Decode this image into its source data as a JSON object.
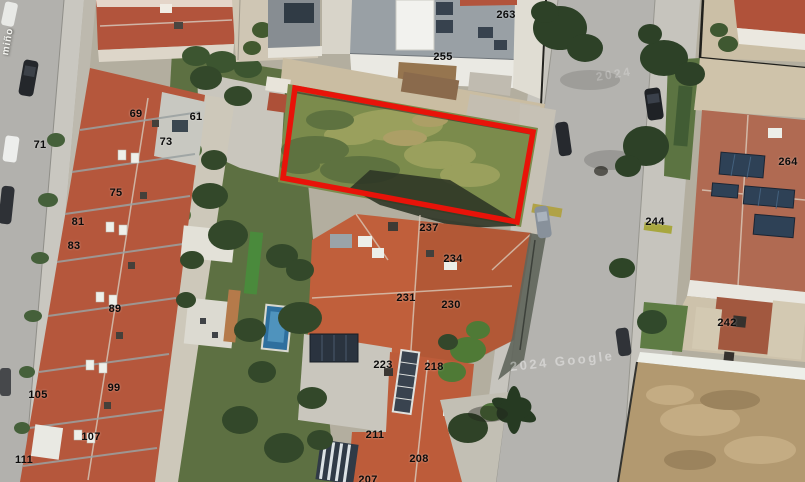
{
  "map": {
    "type": "satellite-aerial-view",
    "street_label": "miño",
    "watermarks": [
      {
        "text": "2024",
        "x": 596,
        "y": 82,
        "rotation": -9,
        "opacity": 0.22,
        "size": 12
      },
      {
        "text": "2024 Google",
        "x": 510,
        "y": 372,
        "rotation": -6,
        "opacity": 0.4,
        "size": 13
      }
    ],
    "parcel_outline": {
      "color": "#e81309",
      "stroke_width": 5.5,
      "points": "295,88 533,132 517,222 283,178"
    },
    "labels": [
      {
        "text": "69",
        "x": 136,
        "y": 114
      },
      {
        "text": "61",
        "x": 196,
        "y": 117
      },
      {
        "text": "71",
        "x": 40,
        "y": 145
      },
      {
        "text": "73",
        "x": 166,
        "y": 142
      },
      {
        "text": "75",
        "x": 116,
        "y": 193
      },
      {
        "text": "81",
        "x": 78,
        "y": 222
      },
      {
        "text": "83",
        "x": 74,
        "y": 246
      },
      {
        "text": "89",
        "x": 115,
        "y": 309
      },
      {
        "text": "99",
        "x": 114,
        "y": 388
      },
      {
        "text": "105",
        "x": 38,
        "y": 395
      },
      {
        "text": "107",
        "x": 91,
        "y": 437
      },
      {
        "text": "111",
        "x": 24,
        "y": 460
      },
      {
        "text": "255",
        "x": 443,
        "y": 57
      },
      {
        "text": "263",
        "x": 506,
        "y": 15
      },
      {
        "text": "237",
        "x": 429,
        "y": 228
      },
      {
        "text": "234",
        "x": 453,
        "y": 259
      },
      {
        "text": "231",
        "x": 406,
        "y": 298
      },
      {
        "text": "230",
        "x": 451,
        "y": 305
      },
      {
        "text": "223",
        "x": 383,
        "y": 365
      },
      {
        "text": "218",
        "x": 434,
        "y": 367
      },
      {
        "text": "211",
        "x": 375,
        "y": 435
      },
      {
        "text": "208",
        "x": 419,
        "y": 459
      },
      {
        "text": "207",
        "x": 368,
        "y": 480
      },
      {
        "text": "244",
        "x": 655,
        "y": 222
      },
      {
        "text": "264",
        "x": 788,
        "y": 162
      },
      {
        "text": "242",
        "x": 727,
        "y": 323
      }
    ],
    "colors": {
      "parcel_red": "#e81309",
      "roof_terracotta": "#b5573c",
      "grass_lot": "#7b8b4c",
      "street_gray": "#b4b3af",
      "solar_navy": "#2e4156",
      "tree_green": "#2d4127",
      "dirt": "#b29970"
    }
  }
}
